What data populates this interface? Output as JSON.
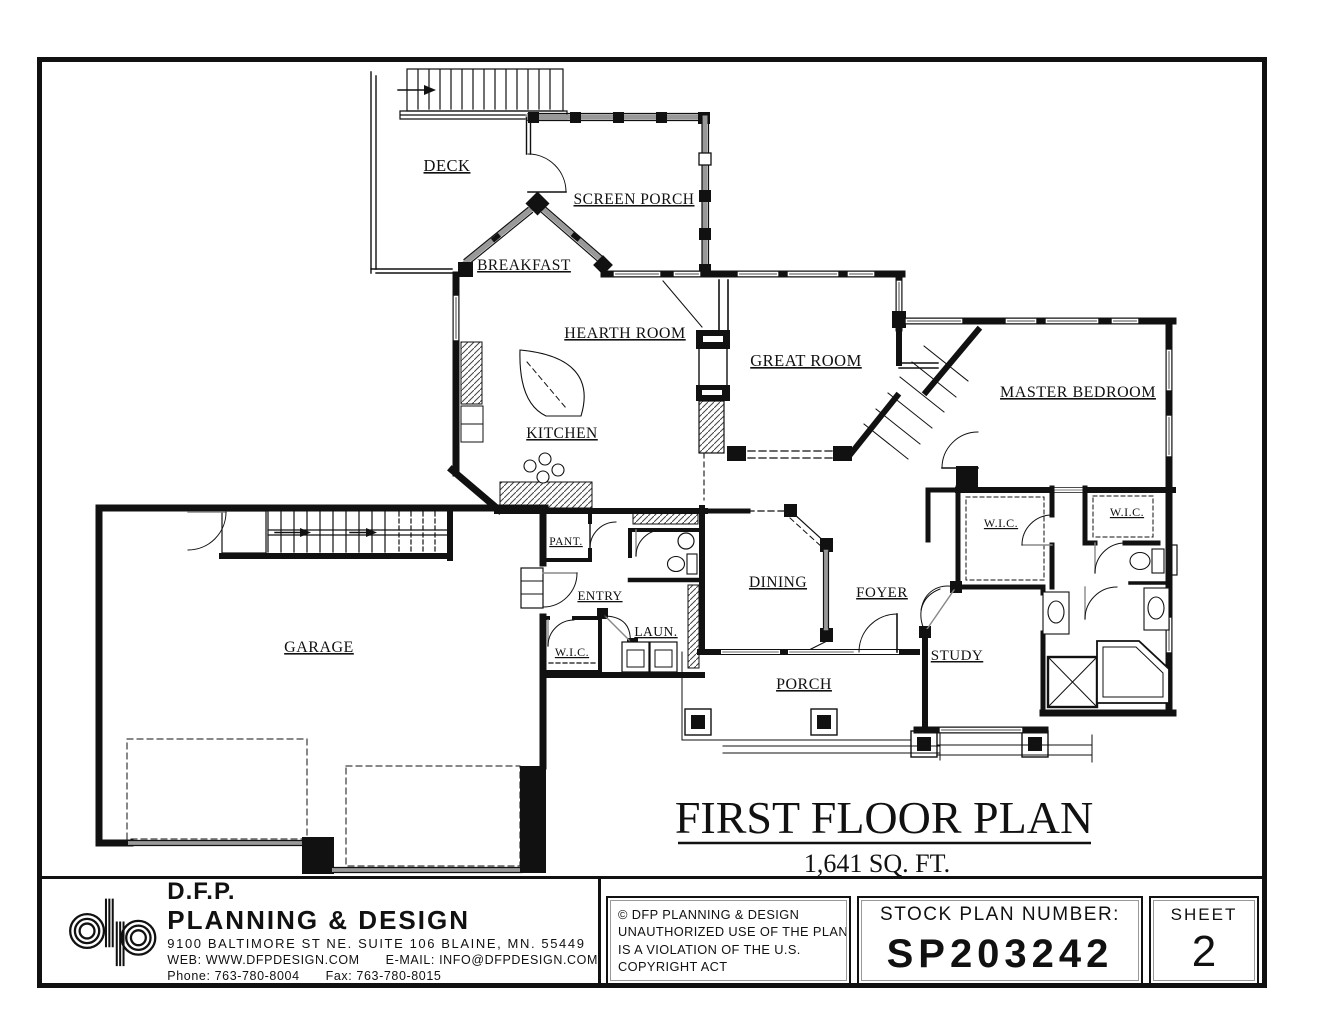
{
  "plan": {
    "title": "FIRST FLOOR PLAN",
    "area": "1,641 SQ. FT."
  },
  "rooms": {
    "deck": "DECK",
    "screen_porch": "SCREEN PORCH",
    "breakfast": "BREAKFAST",
    "hearth_room": "HEARTH ROOM",
    "great_room": "GREAT ROOM",
    "master_bedroom": "MASTER BEDROOM",
    "kitchen": "KITCHEN",
    "garage": "GARAGE",
    "pantry": "PANT.",
    "entry": "ENTRY",
    "wic_entry": "W.I.C.",
    "laundry": "LAUN.",
    "dining": "DINING",
    "foyer": "FOYER",
    "wic_master": "W.I.C.",
    "wic_master_2": "W.I.C.",
    "study": "STUDY",
    "porch": "PORCH"
  },
  "title_block": {
    "logo": "dp",
    "company_abbr": "D.F.P.",
    "company_name": "PLANNING  &  DESIGN",
    "address": "9100  BALTIMORE  ST  NE.  SUITE  106  BLAINE,  MN.  55449",
    "web": "WEB:  WWW.DFPDESIGN.COM",
    "email": "E-MAIL:  INFO@DFPDESIGN.COM",
    "phone": "Phone:  763-780-8004",
    "fax": "Fax:  763-780-8015",
    "copyright_line1": "©  DFP PLANNING & DESIGN",
    "copyright_line2": "UNAUTHORIZED USE OF THE PLAN",
    "copyright_line3": "IS A VIOLATION OF THE U.S.",
    "copyright_line4": "COPYRIGHT ACT",
    "stock_plan_label": "STOCK PLAN NUMBER:",
    "stock_plan_number": "SP203242",
    "sheet_label": "SHEET",
    "sheet_number": "2"
  }
}
